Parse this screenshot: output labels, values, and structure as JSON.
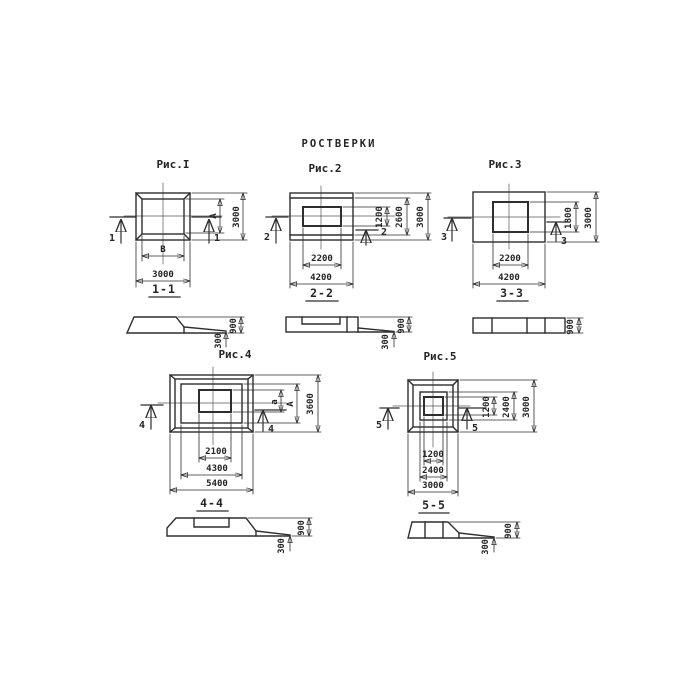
{
  "title": "РОСТВЕРКИ",
  "figures": [
    {
      "id": "fig1",
      "label": "Рис.I",
      "section": "1-1",
      "marker": "1",
      "dims": {
        "inner_width": "В",
        "outer_width": "3000",
        "inner_height": "А",
        "outer_height": "3000"
      }
    },
    {
      "id": "fig2",
      "label": "Рис.2",
      "section": "2-2",
      "marker": "2",
      "dims": {
        "inner_width": "2200",
        "outer_width": "4200",
        "opening_height": "1200",
        "mid_height": "2600",
        "outer_height": "3000"
      }
    },
    {
      "id": "fig3",
      "label": "Рис.3",
      "section": "3-3",
      "marker": "3",
      "dims": {
        "inner_width": "2200",
        "outer_width": "4200",
        "opening_height": "1800",
        "outer_height": "3000"
      }
    },
    {
      "id": "fig4",
      "label": "Рис.4",
      "section": "4-4",
      "marker": "4",
      "dims": {
        "inner_width": "2100",
        "mid_width": "4300",
        "outer_width": "5400",
        "inner_height": "а",
        "mid_height": "А",
        "outer_height": "3600"
      }
    },
    {
      "id": "fig5",
      "label": "Рис.5",
      "section": "5-5",
      "marker": "5",
      "dims": {
        "inner_width": "1200",
        "mid_width": "2400",
        "outer_width": "3000",
        "inner_height": "1200",
        "mid_height": "2400",
        "outer_height": "3000"
      }
    }
  ],
  "sections": [
    {
      "id": "sec1",
      "total_height": "900",
      "step_height": "300"
    },
    {
      "id": "sec2",
      "total_height": "900",
      "step_height": "300"
    },
    {
      "id": "sec3",
      "total_height": "900"
    },
    {
      "id": "sec4",
      "total_height": "900",
      "step_height": "300"
    },
    {
      "id": "sec5",
      "total_height": "900",
      "step_height": "300"
    }
  ]
}
